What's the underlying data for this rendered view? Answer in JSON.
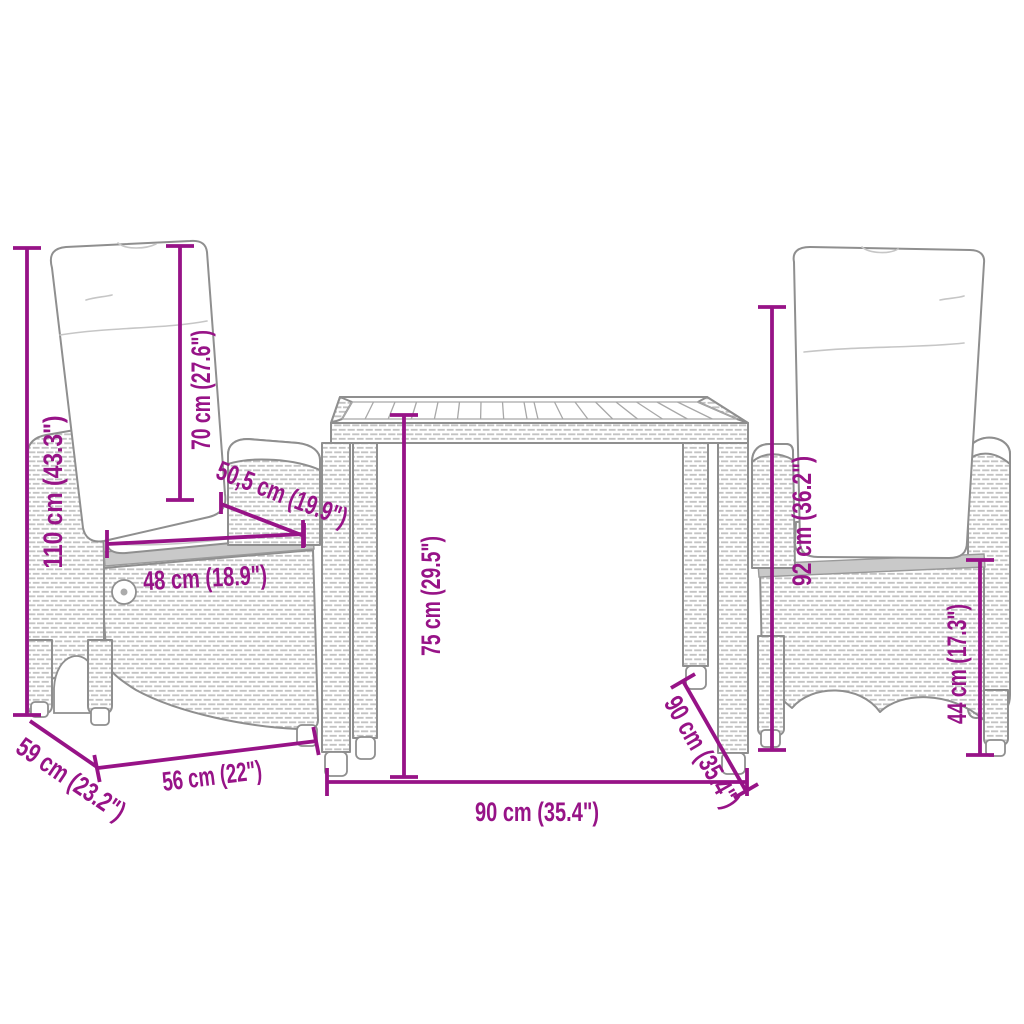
{
  "colors": {
    "dimension_accent": "#971387",
    "furniture_line": "#8f8f8f",
    "rattan_texture": "#c3c3c3",
    "wood_strip": "#c9c9c9",
    "background": "#ffffff"
  },
  "diagram": {
    "left_chair": {
      "total_height": "110 cm (43.3\")",
      "backrest_height": "70 cm (27.6\")",
      "seat_depth": "50,5 cm (19.9\")",
      "seat_width": "48 cm (18.9\")",
      "overall_width": "56 cm (22\")",
      "overall_depth": "59 cm (23.2\")"
    },
    "table": {
      "height": "75 cm (29.5\")",
      "width": "90 cm (35.4\")",
      "depth": "90 cm (35.4\")"
    },
    "right_chair": {
      "back_height": "92 cm (36.2\")",
      "seat_height": "44 cm (17.3\")"
    }
  }
}
